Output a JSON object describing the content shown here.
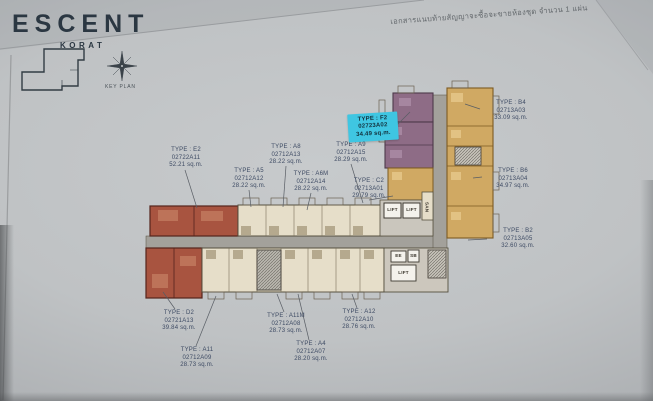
{
  "header": {
    "brand": "ESCENT",
    "brand_sub": "KORAT",
    "key_plan_label": "KEY PLAN",
    "doc_note_thai": "เอกสารแนบท้ายสัญญาจะซื้อจะขายห้องชุด จำนวน 1 แผ่น"
  },
  "plan": {
    "core": {
      "lift": "LIFT",
      "san": "SAN",
      "ee": "EE",
      "sb": "SB"
    },
    "units": [
      {
        "type": "TYPE : E2",
        "code": "02722A11",
        "area": "52.21 sq.m."
      },
      {
        "type": "TYPE : A5",
        "code": "02712A12",
        "area": "28.22 sq.m."
      },
      {
        "type": "TYPE : A8",
        "code": "02712A13",
        "area": "28.22 sq.m."
      },
      {
        "type": "TYPE : A6M",
        "code": "02712A14",
        "area": "28.22 sq.m."
      },
      {
        "type": "TYPE : A9",
        "code": "02712A15",
        "area": "28.29 sq.m."
      },
      {
        "type": "TYPE : C2",
        "code": "02713A01",
        "area": "29.79 sq.m."
      },
      {
        "type": "TYPE : F2",
        "code": "02723A02",
        "area": "34.49 sq.m.",
        "highlighted": true
      },
      {
        "type": "TYPE : B4",
        "code": "02713A03",
        "area": "33.09 sq.m."
      },
      {
        "type": "TYPE : B6",
        "code": "02713A04",
        "area": "34.97 sq.m."
      },
      {
        "type": "TYPE : B2",
        "code": "02713A05",
        "area": "32.60 sq.m."
      },
      {
        "type": "TYPE : D2",
        "code": "02721A13",
        "area": "39.84 sq.m."
      },
      {
        "type": "TYPE : A11",
        "code": "02712A09",
        "area": "28.73 sq.m."
      },
      {
        "type": "TYPE : A11M",
        "code": "02712A08",
        "area": "28.73 sq.m."
      },
      {
        "type": "TYPE : A4",
        "code": "02712A07",
        "area": "28.20 sq.m."
      },
      {
        "type": "TYPE : A12",
        "code": "02712A10",
        "area": "28.76 sq.m."
      }
    ],
    "highlight_color": "#3fc6e2"
  },
  "palette": {
    "paper": "#c2c5c7",
    "unit_beige": "#e6dec9",
    "unit_red": "#a85440",
    "unit_purple": "#8e6c86",
    "unit_gold": "#d0a963",
    "corridor": "#a3a19b",
    "label_text": "#3d4a63",
    "logo_text": "#2b3742"
  }
}
